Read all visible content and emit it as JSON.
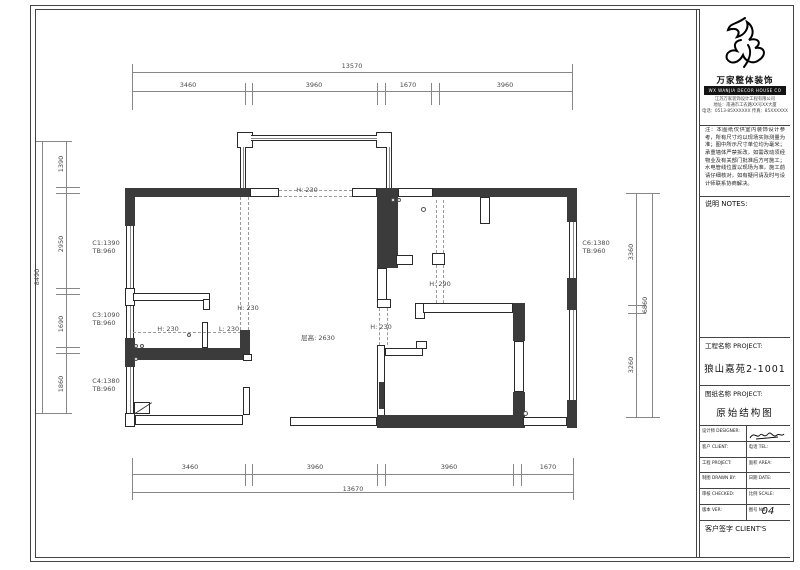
{
  "title_block": {
    "brand_cn": "万家整体装饰",
    "brand_en": "WX WANJIA DECOR HOUSE CO",
    "addr_lines": [
      "江苏万家装饰设计工程有限公司",
      "地址：南通市工农路XX号XX大厦",
      "电话：0513-85XXXXXX 传真：85XXXXXX"
    ],
    "notes_paragraph": "注：本图纸仅供室内装饰设计参考，所有尺寸均以现场实际测量为准；图中所示尺寸单位均为毫米；承重墙体严禁拆改，如需改动须经物业及有关部门批准后方可施工；水电管线位置以现场为准，施工前请仔细核对，如有疑问请及时与设计师联系协商解决。",
    "notes_label": "说明 NOTES:",
    "project_label": "工程名称 PROJECT:",
    "project_value": "狼山嘉苑2-1001",
    "drawing_label": "图纸名称 PROJECT:",
    "drawing_value": "原始结构图",
    "table_rows": [
      {
        "l": "设计师 DESIGNER:",
        "r": ""
      },
      {
        "l": "客户 CLIENT:",
        "r": "电话 TEL:"
      },
      {
        "l": "工程 PROJECT:",
        "r": "面积 AREA:"
      },
      {
        "l": "制图 DRAWN BY:",
        "r": "日期 DATE:"
      },
      {
        "l": "审核 CHECKED:",
        "r": "比例 SCALE:"
      },
      {
        "l": "版本 VER:",
        "r": "图号 NO."
      }
    ],
    "sheet_no": "04",
    "client_label": "客户签字 CLIENT'S"
  },
  "plan": {
    "dimensions": {
      "top": {
        "total": "13570",
        "segments": [
          "3460",
          "3960",
          "1670",
          "3960"
        ]
      },
      "bottom": {
        "total": "13670",
        "segments": [
          "3460",
          "3960",
          "3960",
          "1670"
        ]
      },
      "left": {
        "total": "8490",
        "segments": [
          "1390",
          "2950",
          "1690",
          "1860"
        ]
      },
      "right": {
        "total": "6860",
        "segments": [
          "3360",
          "3260"
        ]
      }
    },
    "window_codes": [
      "C1:1390 TB:960",
      "C3:1090 TB:960",
      "C4:1380 TB:960",
      "C6:1380 TB:960"
    ],
    "beam_notes": [
      "H: 230",
      "H: 230",
      "L: 230",
      "H: 230",
      "H: 230",
      "H: 290"
    ],
    "height_note": "层高: 2630",
    "elements": [
      {
        "t": "lv",
        "x": 132,
        "y": 64,
        "w": 1,
        "h": 46
      },
      {
        "t": "lv",
        "x": 572,
        "y": 64,
        "w": 1,
        "h": 46
      },
      {
        "t": "lh",
        "x": 132,
        "y": 72,
        "w": 441,
        "h": 1
      },
      {
        "t": "lh",
        "x": 132,
        "y": 91,
        "w": 441,
        "h": 1
      },
      {
        "t": "lv",
        "x": 245,
        "y": 83,
        "w": 1,
        "h": 22
      },
      {
        "t": "lv",
        "x": 252,
        "y": 83,
        "w": 1,
        "h": 22
      },
      {
        "t": "lv",
        "x": 377,
        "y": 83,
        "w": 1,
        "h": 22
      },
      {
        "t": "lv",
        "x": 385,
        "y": 83,
        "w": 1,
        "h": 22
      },
      {
        "t": "lv",
        "x": 431,
        "y": 83,
        "w": 1,
        "h": 22
      },
      {
        "t": "lv",
        "x": 439,
        "y": 83,
        "w": 1,
        "h": 22
      },
      {
        "t": "lv",
        "x": 132,
        "y": 458,
        "w": 1,
        "h": 42
      },
      {
        "t": "lv",
        "x": 573,
        "y": 458,
        "w": 1,
        "h": 42
      },
      {
        "t": "lh",
        "x": 132,
        "y": 474,
        "w": 442,
        "h": 1
      },
      {
        "t": "lh",
        "x": 132,
        "y": 492,
        "w": 442,
        "h": 1
      },
      {
        "t": "lv",
        "x": 245,
        "y": 464,
        "w": 1,
        "h": 22
      },
      {
        "t": "lv",
        "x": 252,
        "y": 464,
        "w": 1,
        "h": 22
      },
      {
        "t": "lv",
        "x": 377,
        "y": 464,
        "w": 1,
        "h": 22
      },
      {
        "t": "lv",
        "x": 385,
        "y": 464,
        "w": 1,
        "h": 22
      },
      {
        "t": "lv",
        "x": 513,
        "y": 464,
        "w": 1,
        "h": 22
      },
      {
        "t": "lv",
        "x": 521,
        "y": 464,
        "w": 1,
        "h": 22
      },
      {
        "t": "lh",
        "x": 36,
        "y": 141,
        "w": 36,
        "h": 1
      },
      {
        "t": "lh",
        "x": 36,
        "y": 413,
        "w": 36,
        "h": 1
      },
      {
        "t": "lv",
        "x": 42,
        "y": 141,
        "w": 1,
        "h": 273
      },
      {
        "t": "lv",
        "x": 66,
        "y": 141,
        "w": 1,
        "h": 273
      },
      {
        "t": "lh",
        "x": 56,
        "y": 187,
        "w": 24,
        "h": 1
      },
      {
        "t": "lh",
        "x": 56,
        "y": 193,
        "w": 24,
        "h": 1
      },
      {
        "t": "lh",
        "x": 56,
        "y": 288,
        "w": 24,
        "h": 1
      },
      {
        "t": "lh",
        "x": 56,
        "y": 294,
        "w": 24,
        "h": 1
      },
      {
        "t": "lh",
        "x": 56,
        "y": 347,
        "w": 24,
        "h": 1
      },
      {
        "t": "lh",
        "x": 56,
        "y": 353,
        "w": 24,
        "h": 1
      },
      {
        "t": "lh",
        "x": 626,
        "y": 193,
        "w": 34,
        "h": 1
      },
      {
        "t": "lh",
        "x": 626,
        "y": 417,
        "w": 34,
        "h": 1
      },
      {
        "t": "lv",
        "x": 636,
        "y": 193,
        "w": 1,
        "h": 225
      },
      {
        "t": "lv",
        "x": 652,
        "y": 193,
        "w": 1,
        "h": 225
      },
      {
        "t": "lh",
        "x": 628,
        "y": 305,
        "w": 18,
        "h": 1
      },
      {
        "t": "lh",
        "x": 628,
        "y": 313,
        "w": 18,
        "h": 1
      },
      {
        "t": "tn",
        "x": 237,
        "y": 132,
        "w": 16,
        "h": 16
      },
      {
        "t": "tn",
        "x": 376,
        "y": 132,
        "w": 16,
        "h": 16
      },
      {
        "t": "wh",
        "x": 251,
        "y": 135,
        "w": 126,
        "h": 6
      },
      {
        "t": "wv",
        "x": 240,
        "y": 147,
        "w": 6,
        "h": 42
      },
      {
        "t": "wv",
        "x": 386,
        "y": 147,
        "w": 6,
        "h": 42
      },
      {
        "t": "dk",
        "x": 125,
        "y": 188,
        "w": 125,
        "h": 9
      },
      {
        "t": "tn",
        "x": 250,
        "y": 188,
        "w": 29,
        "h": 9
      },
      {
        "t": "dh",
        "x": 279,
        "y": 190,
        "w": 73,
        "h": 1
      },
      {
        "t": "dh",
        "x": 279,
        "y": 196,
        "w": 73,
        "h": 1
      },
      {
        "t": "tn",
        "x": 352,
        "y": 188,
        "w": 25,
        "h": 9
      },
      {
        "t": "dk",
        "x": 377,
        "y": 188,
        "w": 21,
        "h": 80
      },
      {
        "t": "tn",
        "x": 398,
        "y": 188,
        "w": 35,
        "h": 9
      },
      {
        "t": "dk",
        "x": 433,
        "y": 188,
        "w": 144,
        "h": 9
      },
      {
        "t": "dk",
        "x": 567,
        "y": 197,
        "w": 10,
        "h": 25
      },
      {
        "t": "dk",
        "x": 125,
        "y": 197,
        "w": 10,
        "h": 29
      },
      {
        "t": "wv",
        "x": 126,
        "y": 226,
        "w": 8,
        "h": 62
      },
      {
        "t": "tn",
        "x": 125,
        "y": 288,
        "w": 10,
        "h": 18
      },
      {
        "t": "wv",
        "x": 126,
        "y": 306,
        "w": 8,
        "h": 32
      },
      {
        "t": "dk",
        "x": 125,
        "y": 338,
        "w": 10,
        "h": 29
      },
      {
        "t": "wv",
        "x": 126,
        "y": 367,
        "w": 8,
        "h": 46
      },
      {
        "t": "tn",
        "x": 125,
        "y": 413,
        "w": 10,
        "h": 14
      },
      {
        "t": "tn",
        "x": 133,
        "y": 293,
        "w": 77,
        "h": 8
      },
      {
        "t": "tn",
        "x": 203,
        "y": 299,
        "w": 7,
        "h": 11
      },
      {
        "t": "tn",
        "x": 202,
        "y": 322,
        "w": 6,
        "h": 26
      },
      {
        "t": "dh",
        "x": 133,
        "y": 332,
        "w": 108,
        "h": 1
      },
      {
        "t": "dk",
        "x": 133,
        "y": 348,
        "w": 117,
        "h": 12
      },
      {
        "t": "dk",
        "x": 240,
        "y": 330,
        "w": 10,
        "h": 20
      },
      {
        "t": "tn",
        "x": 243,
        "y": 354,
        "w": 9,
        "h": 7
      },
      {
        "t": "dv",
        "x": 240,
        "y": 197,
        "w": 1,
        "h": 133
      },
      {
        "t": "dv",
        "x": 248,
        "y": 197,
        "w": 1,
        "h": 133
      },
      {
        "t": "tn",
        "x": 396,
        "y": 255,
        "w": 17,
        "h": 10
      },
      {
        "t": "tn",
        "x": 377,
        "y": 268,
        "w": 10,
        "h": 33
      },
      {
        "t": "tn",
        "x": 377,
        "y": 299,
        "w": 14,
        "h": 9
      },
      {
        "t": "dv",
        "x": 379,
        "y": 308,
        "w": 1,
        "h": 37
      },
      {
        "t": "dv",
        "x": 387,
        "y": 308,
        "w": 1,
        "h": 37
      },
      {
        "t": "tn",
        "x": 377,
        "y": 345,
        "w": 8,
        "h": 73
      },
      {
        "t": "tn",
        "x": 385,
        "y": 348,
        "w": 38,
        "h": 8
      },
      {
        "t": "tn",
        "x": 416,
        "y": 341,
        "w": 11,
        "h": 8
      },
      {
        "t": "dk",
        "x": 379,
        "y": 382,
        "w": 5,
        "h": 27
      },
      {
        "t": "tn",
        "x": 415,
        "y": 303,
        "w": 10,
        "h": 16
      },
      {
        "t": "tn",
        "x": 423,
        "y": 303,
        "w": 90,
        "h": 10
      },
      {
        "t": "tn",
        "x": 432,
        "y": 253,
        "w": 13,
        "h": 12
      },
      {
        "t": "dv",
        "x": 436,
        "y": 200,
        "w": 1,
        "h": 53
      },
      {
        "t": "dv",
        "x": 443,
        "y": 200,
        "w": 1,
        "h": 53
      },
      {
        "t": "dv",
        "x": 436,
        "y": 265,
        "w": 1,
        "h": 38
      },
      {
        "t": "dv",
        "x": 443,
        "y": 265,
        "w": 1,
        "h": 38
      },
      {
        "t": "tn",
        "x": 480,
        "y": 197,
        "w": 10,
        "h": 27
      },
      {
        "t": "dk",
        "x": 513,
        "y": 303,
        "w": 12,
        "h": 38
      },
      {
        "t": "tn",
        "x": 514,
        "y": 341,
        "w": 10,
        "h": 51
      },
      {
        "t": "dk",
        "x": 513,
        "y": 392,
        "w": 12,
        "h": 36
      },
      {
        "t": "wv",
        "x": 569,
        "y": 222,
        "w": 8,
        "h": 56
      },
      {
        "t": "dk",
        "x": 567,
        "y": 278,
        "w": 10,
        "h": 32
      },
      {
        "t": "wv",
        "x": 569,
        "y": 310,
        "w": 8,
        "h": 90
      },
      {
        "t": "dk",
        "x": 567,
        "y": 400,
        "w": 10,
        "h": 28
      },
      {
        "t": "tn",
        "x": 135,
        "y": 415,
        "w": 108,
        "h": 10
      },
      {
        "t": "tn",
        "x": 243,
        "y": 387,
        "w": 7,
        "h": 28
      },
      {
        "t": "tn",
        "x": 290,
        "y": 417,
        "w": 87,
        "h": 9
      },
      {
        "t": "dk",
        "x": 377,
        "y": 415,
        "w": 146,
        "h": 13
      },
      {
        "t": "tn",
        "x": 523,
        "y": 417,
        "w": 44,
        "h": 9
      },
      {
        "t": "tn",
        "x": 134,
        "y": 402,
        "w": 16,
        "h": 12
      },
      {
        "t": "dg",
        "x": 135,
        "y": 413,
        "w": 20,
        "h": 1
      },
      {
        "t": "cc",
        "x": 391,
        "y": 198,
        "w": 4,
        "h": 4
      },
      {
        "t": "cc",
        "x": 397,
        "y": 198,
        "w": 4,
        "h": 4
      },
      {
        "t": "cc",
        "x": 421,
        "y": 207,
        "w": 5,
        "h": 5
      },
      {
        "t": "cc",
        "x": 134,
        "y": 344,
        "w": 4,
        "h": 4
      },
      {
        "t": "cc",
        "x": 140,
        "y": 344,
        "w": 4,
        "h": 4
      },
      {
        "t": "cc",
        "x": 134,
        "y": 357,
        "w": 4,
        "h": 4
      },
      {
        "t": "cc",
        "x": 523,
        "y": 411,
        "w": 5,
        "h": 5
      },
      {
        "t": "cc",
        "x": 187,
        "y": 333,
        "w": 4,
        "h": 4
      }
    ],
    "labels": [
      {
        "text": "13570",
        "x": 352,
        "y": 66
      },
      {
        "text": "3460",
        "x": 188,
        "y": 85
      },
      {
        "text": "3960",
        "x": 314,
        "y": 85
      },
      {
        "text": "1670",
        "x": 408,
        "y": 85
      },
      {
        "text": "3960",
        "x": 505,
        "y": 85
      },
      {
        "text": "3460",
        "x": 190,
        "y": 467
      },
      {
        "text": "3960",
        "x": 315,
        "y": 467
      },
      {
        "text": "3960",
        "x": 449,
        "y": 467
      },
      {
        "text": "1670",
        "x": 548,
        "y": 467
      },
      {
        "text": "13670",
        "x": 353,
        "y": 489
      },
      {
        "text": "8490",
        "x": 37,
        "y": 277,
        "r": 1
      },
      {
        "text": "1390",
        "x": 61,
        "y": 164,
        "r": 1
      },
      {
        "text": "2950",
        "x": 61,
        "y": 244,
        "r": 1
      },
      {
        "text": "1690",
        "x": 61,
        "y": 324,
        "r": 1
      },
      {
        "text": "1860",
        "x": 61,
        "y": 384,
        "r": 1
      },
      {
        "text": "6860",
        "x": 645,
        "y": 305,
        "r": 1
      },
      {
        "text": "3360",
        "x": 631,
        "y": 252,
        "r": 1
      },
      {
        "text": "3260",
        "x": 631,
        "y": 365,
        "r": 1
      },
      {
        "text": "C1:1390",
        "x": 106,
        "y": 243
      },
      {
        "text": "TB:960",
        "x": 104,
        "y": 251
      },
      {
        "text": "C3:1090",
        "x": 106,
        "y": 315
      },
      {
        "text": "TB:960",
        "x": 104,
        "y": 323
      },
      {
        "text": "C4:1380",
        "x": 106,
        "y": 381
      },
      {
        "text": "TB:960",
        "x": 104,
        "y": 389
      },
      {
        "text": "C6:1380",
        "x": 596,
        "y": 243
      },
      {
        "text": "TB:960",
        "x": 594,
        "y": 251
      },
      {
        "text": "H: 230",
        "x": 307,
        "y": 190
      },
      {
        "text": "H: 230",
        "x": 168,
        "y": 329
      },
      {
        "text": "L: 230",
        "x": 229,
        "y": 329
      },
      {
        "text": "H: 230",
        "x": 248,
        "y": 308
      },
      {
        "text": "H: 230",
        "x": 381,
        "y": 327
      },
      {
        "text": "H: 290",
        "x": 440,
        "y": 284
      },
      {
        "text": "层高: 2630",
        "x": 318,
        "y": 337
      }
    ]
  }
}
